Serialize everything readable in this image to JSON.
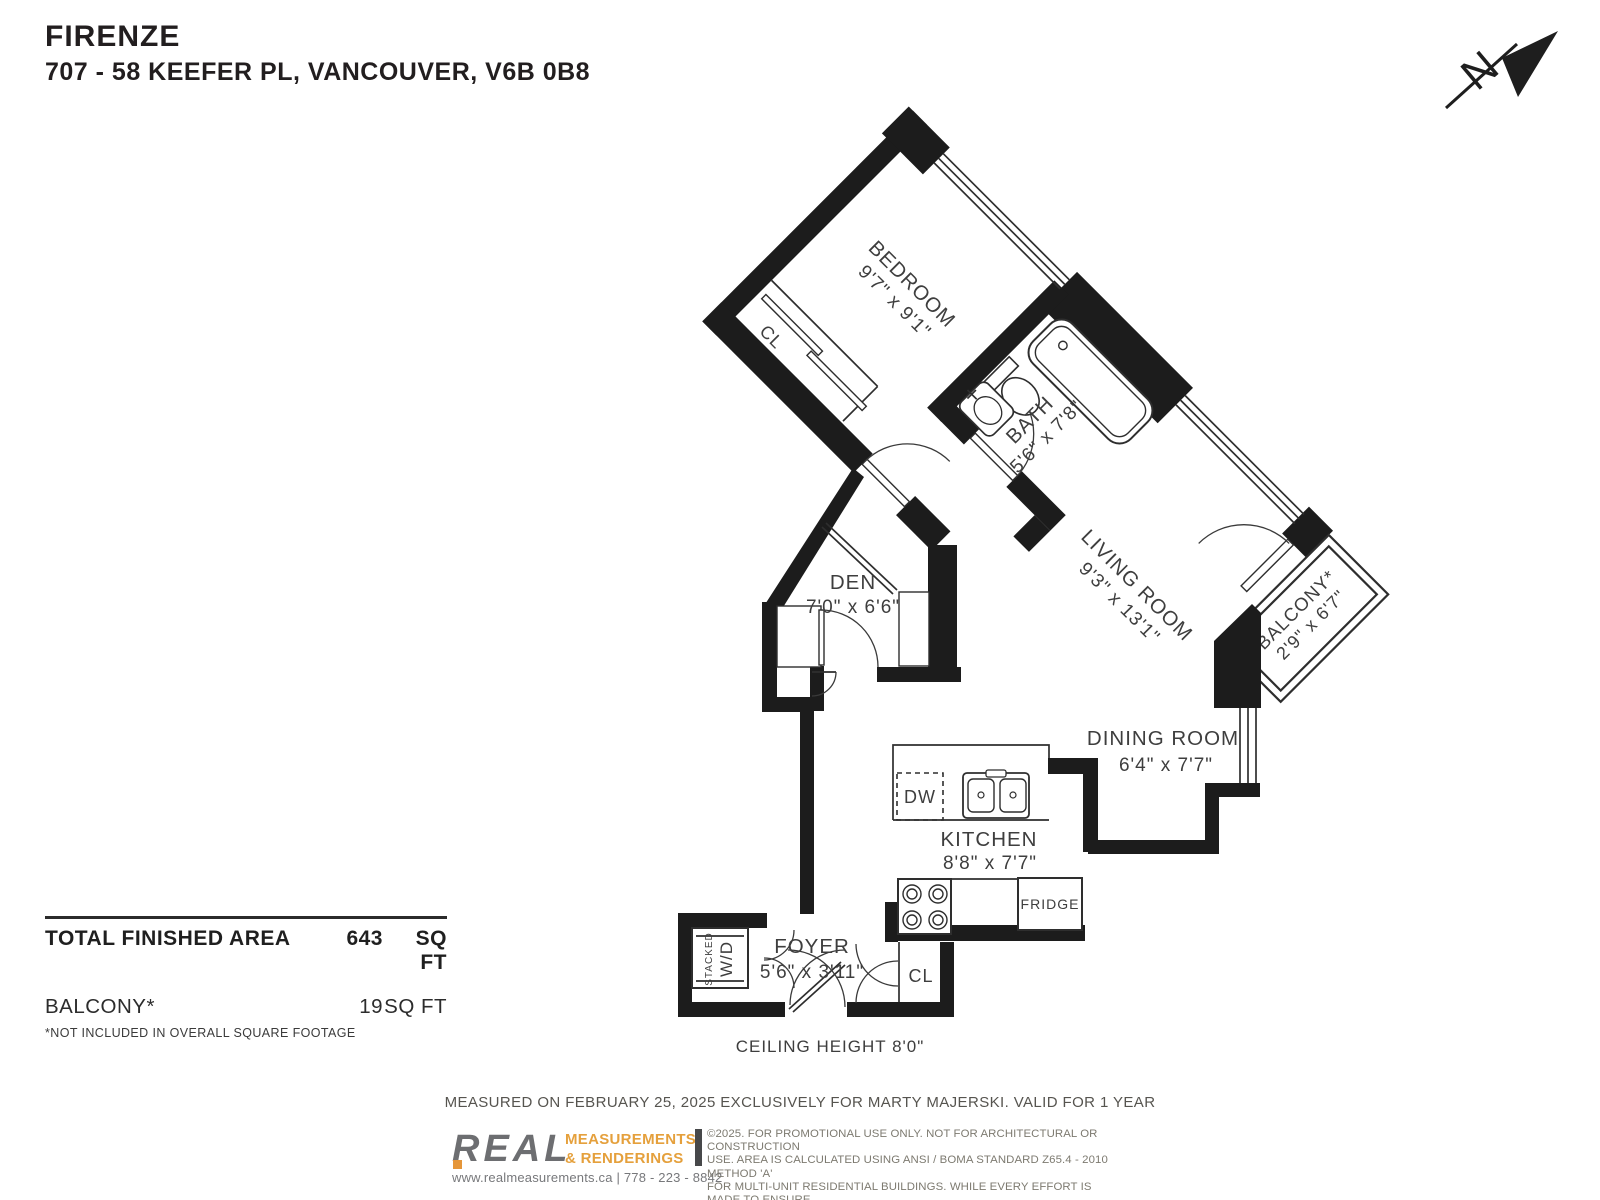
{
  "header": {
    "building": "FIRENZE",
    "address": "707 - 58 KEEFER PL, VANCOUVER, V6B 0B8"
  },
  "compass": {
    "label": "N"
  },
  "rooms": {
    "bedroom": {
      "name": "BEDROOM",
      "dims": "9'7\" x 9'1\""
    },
    "bath": {
      "name": "BATH",
      "dims": "5'6\" x 7'8\""
    },
    "living": {
      "name": "LIVING ROOM",
      "dims": "9'3\" x 13'1\""
    },
    "balcony": {
      "name": "BALCONY*",
      "dims": "2'9\" x 6'7\""
    },
    "den": {
      "name": "DEN",
      "dims": "7'0\" x 6'6\""
    },
    "dining": {
      "name": "DINING ROOM",
      "dims": "6'4\" x 7'7\""
    },
    "kitchen": {
      "name": "KITCHEN",
      "dims": "8'8\" x 7'7\""
    },
    "foyer": {
      "name": "FOYER",
      "dims": "5'6\" x 3'11\""
    }
  },
  "fixtures": {
    "dishwasher": "DW",
    "fridge": "FRIDGE",
    "wd_line1": "STACKED",
    "wd_line2": "W/D",
    "bedroom_closet": "CL",
    "foyer_closet": "CL"
  },
  "areas": {
    "total_label": "TOTAL FINISHED AREA",
    "total_value": "643",
    "total_unit": "SQ FT",
    "balcony_label": "BALCONY*",
    "balcony_value": "19",
    "balcony_unit": "SQ FT",
    "footnote": "*NOT INCLUDED IN OVERALL SQUARE FOOTAGE"
  },
  "notes": {
    "ceiling": "CEILING HEIGHT 8'0\"",
    "measured": "MEASURED ON FEBRUARY 25, 2025 EXCLUSIVELY FOR MARTY MAJERSKI. VALID FOR 1 YEAR"
  },
  "branding": {
    "logo_text": "REAL",
    "tagline1": "MEASUREMENTS",
    "tagline2": "&  RENDERINGS",
    "contact": "www.realmeasurements.ca | 778 - 223 - 8842",
    "disclaimer1": "©2025. FOR PROMOTIONAL USE ONLY. NOT FOR ARCHITECTURAL OR CONSTRUCTION",
    "disclaimer2": "USE. AREA IS CALCULATED USING ANSI / BOMA STANDARD Z65.4 - 2010 METHOD 'A'",
    "disclaimer3": "FOR MULTI-UNIT RESIDENTIAL BUILDINGS. WHILE EVERY EFFORT IS MADE TO ENSURE",
    "disclaimer4": "THE ACCURACY, DIMENSIONS AND TOTAL AREA ARE NOT GUARANTEED. E&OE"
  },
  "colors": {
    "wall": "#1c1c1c",
    "accent_orange": "#e5a03c",
    "logo_gray": "#6d6e71",
    "label_gray": "#3e3e3e"
  }
}
